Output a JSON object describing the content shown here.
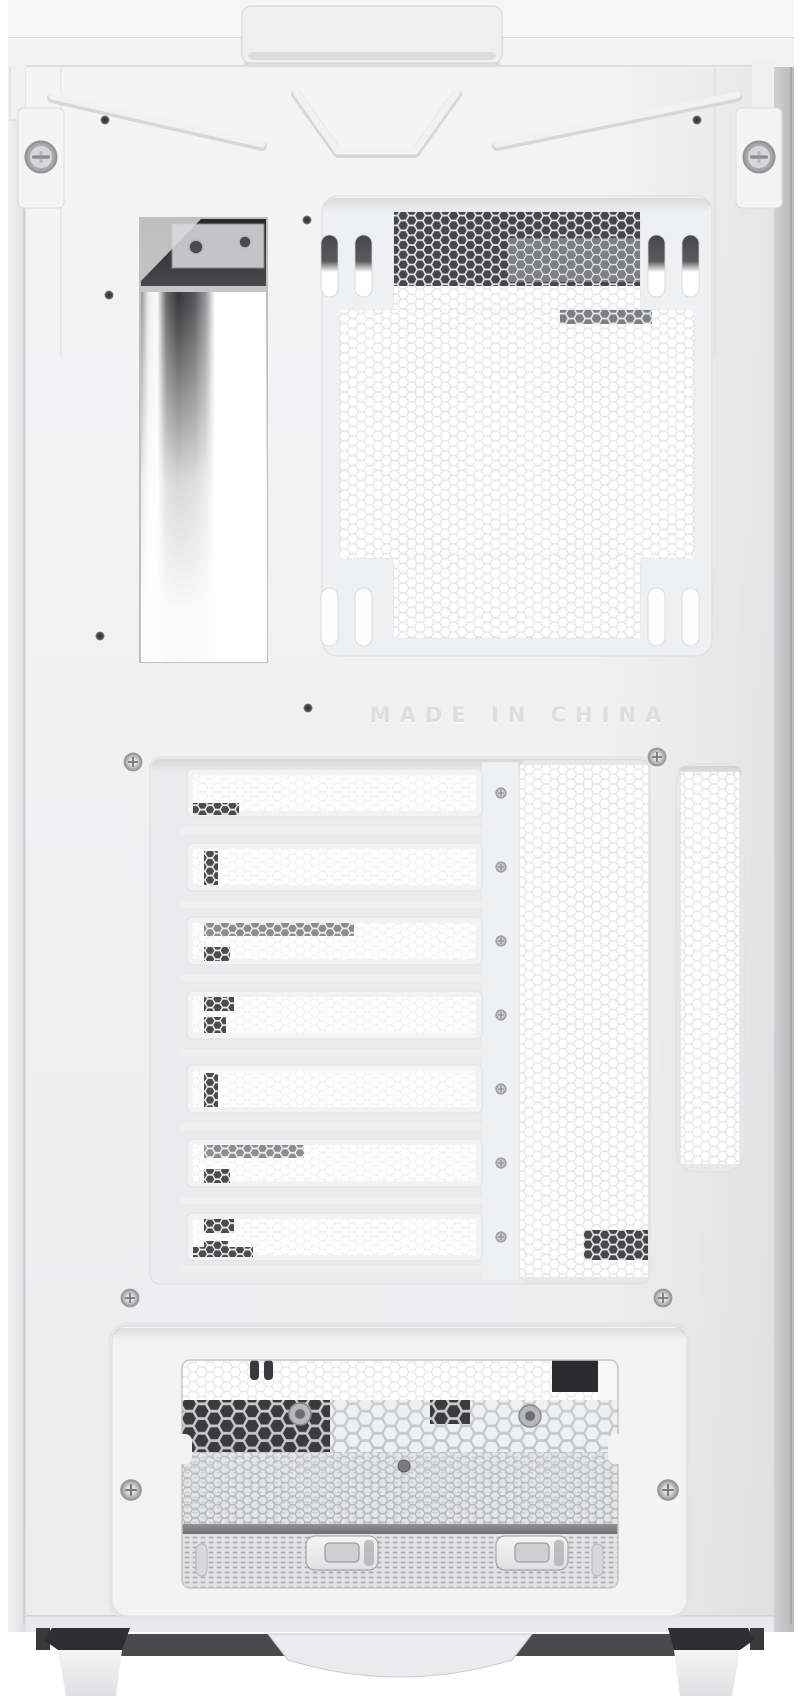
{
  "case": {
    "embossed_text": "MADE IN CHINA",
    "description_labels": {
      "io_cutout": "rear-io-cutout",
      "fan_grille": "exhaust-fan-grille",
      "pci_slots": "expansion-slot-covers",
      "psu_bay": "psu-bay-opening"
    },
    "pci_slot_count": 7
  },
  "colors": {
    "panel": "#f2f2f3",
    "recess": "#ebebed",
    "mesh_wall": "#e7e8ea",
    "interior_dark": "#313133",
    "metal_silver": "#c3c4c6",
    "emboss_text": "#dedee0"
  }
}
